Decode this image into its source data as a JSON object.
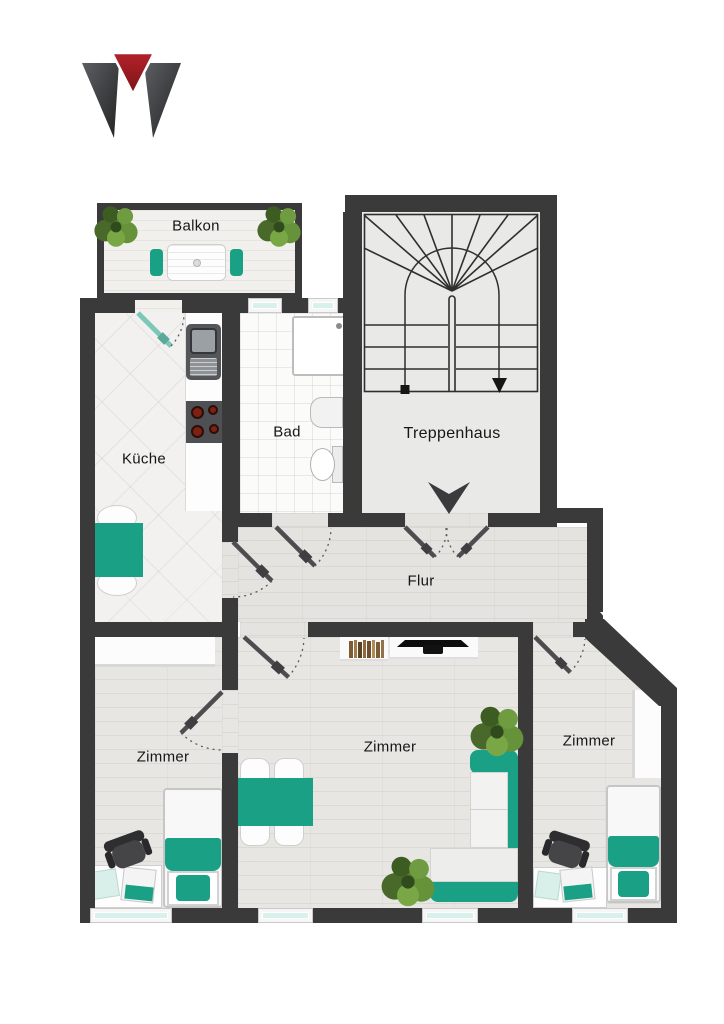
{
  "document": {
    "kind": "apartment floor plan",
    "language": "de",
    "background": "#ffffff"
  },
  "logo": {
    "name": "w-mark-logo",
    "color_dark": "#3e3f41",
    "color_red": "#a81e24"
  },
  "rooms": {
    "balkon": {
      "label": "Balkon",
      "furniture": [
        "plant",
        "plant",
        "bistro-table",
        "chair",
        "chair"
      ]
    },
    "kueche": {
      "label": "Küche",
      "furniture": [
        "counter",
        "sink",
        "stove",
        "table",
        "chair",
        "chair"
      ]
    },
    "bad": {
      "label": "Bad",
      "furniture": [
        "shower",
        "washbasin",
        "toilet"
      ]
    },
    "treppenhaus": {
      "label": "Treppenhaus",
      "furniture": [
        "u-shaped-stairs",
        "walk-line",
        "entrance-arrow"
      ]
    },
    "flur": {
      "label": "Flur",
      "furniture": []
    },
    "zimmer_links": {
      "label": "Zimmer",
      "furniture": [
        "wardrobe",
        "single-bed",
        "desk",
        "office-chair",
        "laptop",
        "papers"
      ]
    },
    "zimmer_mitte": {
      "label": "Zimmer",
      "furniture": [
        "bookshelf",
        "tv",
        "dining-table",
        "four-chairs",
        "corner-sofa",
        "plant",
        "plant"
      ]
    },
    "zimmer_rechts": {
      "label": "Zimmer",
      "furniture": [
        "wardrobe",
        "single-bed",
        "desk",
        "office-chair",
        "laptop",
        "papers"
      ]
    }
  },
  "doors": [
    "balcony-door",
    "kitchen-door",
    "bath-door",
    "entrance-double-door",
    "middle-room-door",
    "left-room-door",
    "right-room-door"
  ],
  "windows": {
    "bath_top": 2,
    "bottom_facade": 4
  },
  "colors": {
    "wall": "#3a3a3b",
    "accent_teal": "#1aa185",
    "accent_teal_dark": "#128a71",
    "window_glass": "#d9f1ec",
    "floor_wood": "#e7e6e3",
    "bath_tile": "#fbfbfa",
    "stair_floor": "#e9e9e8",
    "chair_dark": "#3d3d3f",
    "plant_green": "#567d2e",
    "book_brown": "#8a6a40"
  }
}
